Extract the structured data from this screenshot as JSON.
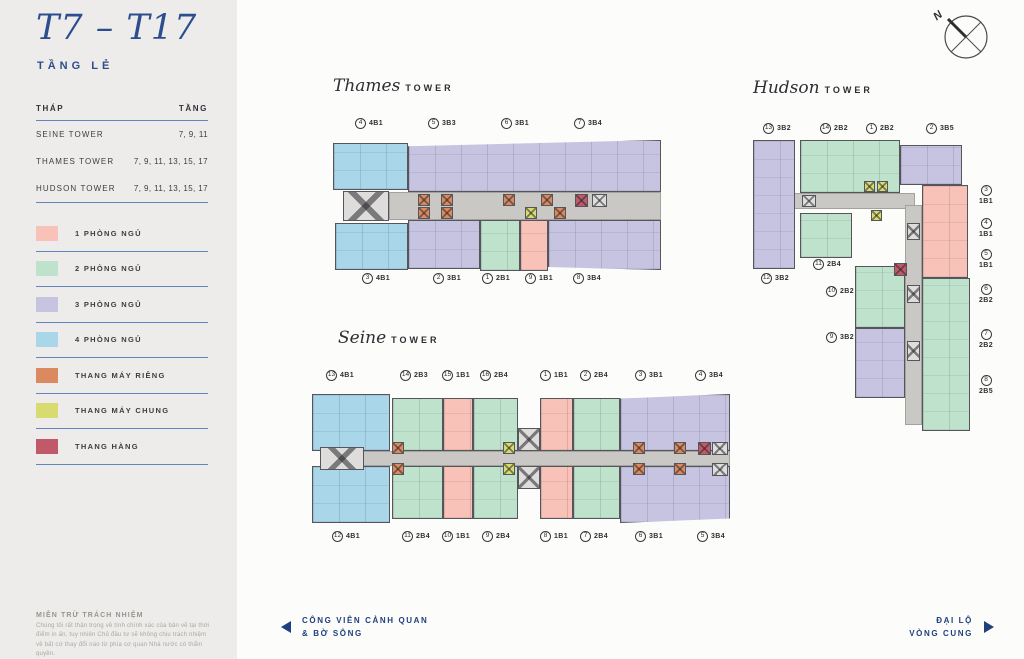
{
  "page": {
    "title": "T7 – T17",
    "subtitle": "TẦNG LẺ",
    "compass_label": "N"
  },
  "floor_table": {
    "col_tower": "THÁP",
    "col_floor": "TẦNG",
    "rows": [
      {
        "tower": "SEINE TOWER",
        "floors": "7, 9, 11"
      },
      {
        "tower": "THAMES TOWER",
        "floors": "7, 9, 11, 13, 15, 17"
      },
      {
        "tower": "HUDSON TOWER",
        "floors": "7, 9, 11, 13, 15, 17"
      }
    ]
  },
  "legend": {
    "items": [
      {
        "label": "1 PHÒNG NGỦ",
        "color": "#f8c2b8"
      },
      {
        "label": "2 PHÒNG NGỦ",
        "color": "#bfe2cc"
      },
      {
        "label": "3 PHÒNG NGỦ",
        "color": "#c7c4e2"
      },
      {
        "label": "4 PHÒNG NGỦ",
        "color": "#a9d6e9"
      },
      {
        "label": "THANG MÁY RIÊNG",
        "color": "#db8a60"
      },
      {
        "label": "THANG MÁY CHUNG",
        "color": "#d8db6f"
      },
      {
        "label": "THANG HÀNG",
        "color": "#c05a68"
      }
    ]
  },
  "disclaimer": {
    "title": "MIỄN TRỪ TRÁCH NHIỆM",
    "body": "Chúng tôi rất thận trọng về tính chính xác của bản vẽ tại thời điểm in ấn, tuy nhiên Chủ đầu tư sẽ không chịu trách nhiệm về bất cứ thay đổi nào từ phía cơ quan Nhà nước có thẩm quyền."
  },
  "towers": {
    "thames": {
      "name": "Thames",
      "suffix": "TOWER",
      "top_labels": [
        {
          "n": "4",
          "c": "4B1"
        },
        {
          "n": "5",
          "c": "3B3"
        },
        {
          "n": "6",
          "c": "3B1"
        },
        {
          "n": "7",
          "c": "3B4"
        }
      ],
      "bottom_labels": [
        {
          "n": "3",
          "c": "4B1"
        },
        {
          "n": "2",
          "c": "3B1"
        },
        {
          "n": "1",
          "c": "2B1"
        },
        {
          "n": "9",
          "c": "1B1"
        },
        {
          "n": "8",
          "c": "3B4"
        }
      ]
    },
    "hudson": {
      "name": "Hudson",
      "suffix": "TOWER",
      "top_labels": [
        {
          "n": "13",
          "c": "3B2"
        },
        {
          "n": "14",
          "c": "2B2"
        },
        {
          "n": "1",
          "c": "2B2"
        },
        {
          "n": "2",
          "c": "3B5"
        }
      ],
      "left_labels": [
        {
          "n": "12",
          "c": "3B2"
        },
        {
          "n": "11",
          "c": "2B4"
        },
        {
          "n": "10",
          "c": "2B2"
        },
        {
          "n": "9",
          "c": "3B2"
        }
      ],
      "right_labels": [
        {
          "n": "3",
          "c": "1B1"
        },
        {
          "n": "4",
          "c": "1B1"
        },
        {
          "n": "5",
          "c": "1B1"
        },
        {
          "n": "6",
          "c": "2B2"
        },
        {
          "n": "7",
          "c": "2B2"
        },
        {
          "n": "8",
          "c": "2B5"
        }
      ]
    },
    "seine": {
      "name": "Seine",
      "suffix": "TOWER",
      "top_labels": [
        {
          "n": "13",
          "c": "4B1"
        },
        {
          "n": "14",
          "c": "2B3"
        },
        {
          "n": "15",
          "c": "1B1"
        },
        {
          "n": "16",
          "c": "2B4"
        },
        {
          "n": "1",
          "c": "1B1"
        },
        {
          "n": "2",
          "c": "2B4"
        },
        {
          "n": "3",
          "c": "3B1"
        },
        {
          "n": "4",
          "c": "3B4"
        }
      ],
      "bottom_labels": [
        {
          "n": "12",
          "c": "4B1"
        },
        {
          "n": "11",
          "c": "2B4"
        },
        {
          "n": "10",
          "c": "1B1"
        },
        {
          "n": "9",
          "c": "2B4"
        },
        {
          "n": "8",
          "c": "1B1"
        },
        {
          "n": "7",
          "c": "2B4"
        },
        {
          "n": "6",
          "c": "3B1"
        },
        {
          "n": "5",
          "c": "3B4"
        }
      ]
    }
  },
  "streets": {
    "left": {
      "line1": "CÔNG VIÊN CẢNH QUAN",
      "line2": "& BỜ SÔNG"
    },
    "right": {
      "line1": "ĐẠI LỘ",
      "line2": "VÒNG CUNG"
    }
  },
  "colors": {
    "navy": "#274a86",
    "rule_blue": "#6286bb",
    "unit_1br": "#f8c2b8",
    "unit_2br": "#bfe2cc",
    "unit_3br": "#c7c4e2",
    "unit_4br": "#a9d6e9",
    "lift_private": "#db8a60",
    "lift_shared": "#d8db6f",
    "lift_service": "#c05a68",
    "corridor": "#c9c8c5",
    "sidebar_bg": "#edecea",
    "canvas_bg": "#fcfcfb"
  }
}
